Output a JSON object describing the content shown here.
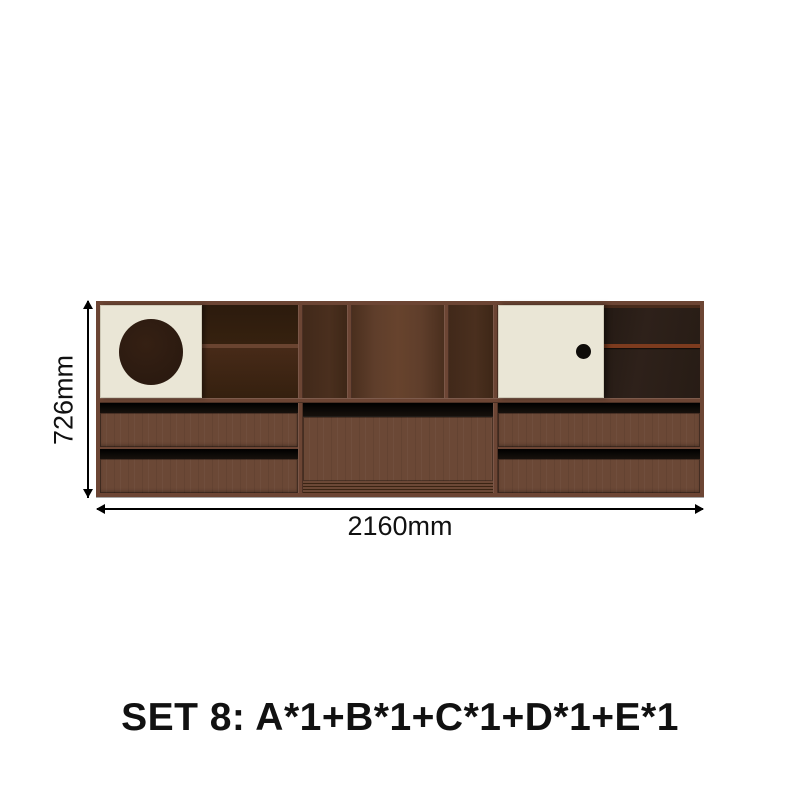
{
  "page": {
    "background": "#ffffff"
  },
  "product_diagram": {
    "height_label": "726mm",
    "width_label": "2160mm",
    "caption": "SET 8: A*1+B*1+C*1+D*1+E*1",
    "furniture": {
      "description": "walnut wall sideboard, top row: circle-cutout sliding-door cabinet, open shelving, sliding-door cabinet with smoked glass; bottom row: two-drawer chest, drop-front cabinet with slatted base, two-drawer chest"
    }
  },
  "colors": {
    "bg": "#ffffff",
    "frame": "#6c4534",
    "wood": "#6b4836",
    "interior-top": "#36210f",
    "interior-bottom": "#472a18",
    "mid-interior": "#5f3e2b",
    "mid-interior-dark": "#4a2f1e",
    "cream": "#eae6d6",
    "cream-edge": "#cfcab8",
    "circle": "#2b1a10",
    "dot": "#0f0c09",
    "handle": "#17110c",
    "glass": "#2e211a",
    "glass-shelf": "#7d3b1e",
    "slat": "#3a2413",
    "line": "#000000",
    "text": "#111111"
  }
}
